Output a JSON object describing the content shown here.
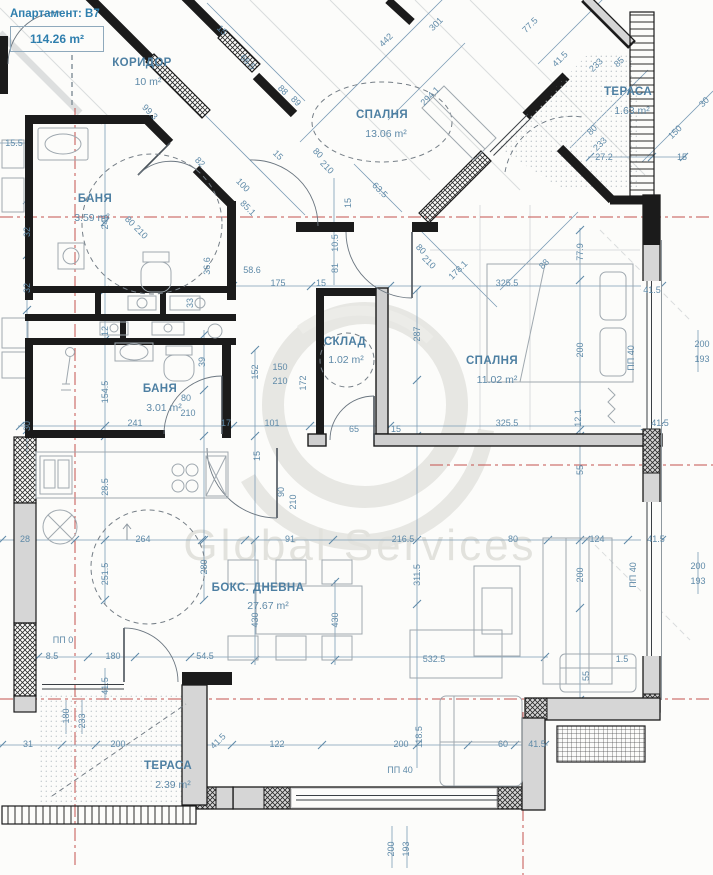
{
  "header": {
    "apartment_label": "Апартамент: B7",
    "total_area": "114.26 m²"
  },
  "watermark": "Global Services",
  "colors": {
    "dimension_blue": "#5f8aa8",
    "room_label_blue": "#4d7fa2",
    "axis_red": "#c4524e",
    "wall_black": "#1b1b1b",
    "wall_gray": "#d6d6d6"
  },
  "rooms": [
    {
      "name": "КОРИДОР",
      "area": "10 m²",
      "x": 142,
      "y": 63,
      "ax": 148,
      "ay": 82
    },
    {
      "name": "СПАЛНЯ",
      "area": "13.06 m²",
      "x": 382,
      "y": 115,
      "ax": 386,
      "ay": 134
    },
    {
      "name": "ТЕРАСА",
      "area": "1.63 m²",
      "x": 628,
      "y": 92,
      "ax": 632,
      "ay": 111
    },
    {
      "name": "БАНЯ",
      "area": "3.59 m²",
      "x": 95,
      "y": 199,
      "ax": 92,
      "ay": 218
    },
    {
      "name": "СКЛАД",
      "area": "1.02 m²",
      "x": 345,
      "y": 342,
      "ax": 346,
      "ay": 360
    },
    {
      "name": "СПАЛНЯ",
      "area": "11.02 m²",
      "x": 492,
      "y": 361,
      "ax": 497,
      "ay": 380
    },
    {
      "name": "БАНЯ",
      "area": "3.01 m²",
      "x": 160,
      "y": 389,
      "ax": 164,
      "ay": 408
    },
    {
      "name": "БОКС. ДНЕВНА",
      "area": "27.67 m²",
      "x": 258,
      "y": 588,
      "ax": 268,
      "ay": 606
    },
    {
      "name": "ТЕРАСА",
      "area": "2.39 m²",
      "x": 168,
      "y": 766,
      "ax": 173,
      "ay": 785
    }
  ],
  "dim_labels": [
    {
      "t": "99.3",
      "x": 150,
      "y": 112,
      "r": 45
    },
    {
      "t": "82",
      "x": 200,
      "y": 162,
      "r": 45
    },
    {
      "t": "100",
      "x": 243,
      "y": 185,
      "r": 45
    },
    {
      "t": "85.1",
      "x": 248,
      "y": 208,
      "r": 45
    },
    {
      "t": "80",
      "x": 130,
      "y": 221,
      "r": 45
    },
    {
      "t": "210",
      "x": 141,
      "y": 232,
      "r": 45
    },
    {
      "t": "15",
      "x": 278,
      "y": 155,
      "r": 45
    },
    {
      "t": "88",
      "x": 283,
      "y": 90,
      "r": 45
    },
    {
      "t": "89",
      "x": 296,
      "y": 101,
      "r": 45
    },
    {
      "t": "66.5",
      "x": 248,
      "y": 62,
      "r": 45
    },
    {
      "t": "15",
      "x": 222,
      "y": 30,
      "r": 45
    },
    {
      "t": "80",
      "x": 318,
      "y": 153,
      "r": 45
    },
    {
      "t": "210",
      "x": 327,
      "y": 167,
      "r": 45
    },
    {
      "t": "63.5",
      "x": 380,
      "y": 190,
      "r": 45
    },
    {
      "t": "15",
      "x": 348,
      "y": 203,
      "r": -90
    },
    {
      "t": "10.5",
      "x": 335,
      "y": 243,
      "r": -90
    },
    {
      "t": "81",
      "x": 335,
      "y": 268,
      "r": -90
    },
    {
      "t": "442",
      "x": 386,
      "y": 40,
      "r": -45
    },
    {
      "t": "301",
      "x": 436,
      "y": 24,
      "r": -45
    },
    {
      "t": "294.1",
      "x": 430,
      "y": 96,
      "r": -45
    },
    {
      "t": "77.5",
      "x": 530,
      "y": 25,
      "r": -45
    },
    {
      "t": "41.5",
      "x": 560,
      "y": 59,
      "r": -45
    },
    {
      "t": "233",
      "x": 596,
      "y": 65,
      "r": -45
    },
    {
      "t": "85",
      "x": 619,
      "y": 62,
      "r": -45
    },
    {
      "t": "80",
      "x": 592,
      "y": 130,
      "r": -45
    },
    {
      "t": "233",
      "x": 600,
      "y": 144,
      "r": -45
    },
    {
      "t": "150",
      "x": 675,
      "y": 132,
      "r": -45
    },
    {
      "t": "30",
      "x": 704,
      "y": 102,
      "r": -45
    },
    {
      "t": "27.2",
      "x": 604,
      "y": 157,
      "r": 0
    },
    {
      "t": "15",
      "x": 682,
      "y": 157,
      "r": 0
    },
    {
      "t": "88",
      "x": 544,
      "y": 264,
      "r": -45
    },
    {
      "t": "178.1",
      "x": 458,
      "y": 270,
      "r": -45
    },
    {
      "t": "80",
      "x": 421,
      "y": 249,
      "r": 45
    },
    {
      "t": "210",
      "x": 429,
      "y": 262,
      "r": 45
    },
    {
      "t": "58.6",
      "x": 252,
      "y": 270,
      "r": 0
    },
    {
      "t": "175",
      "x": 278,
      "y": 283,
      "r": 0
    },
    {
      "t": "15",
      "x": 321,
      "y": 283,
      "r": 0
    },
    {
      "t": "325.5",
      "x": 507,
      "y": 283,
      "r": 0
    },
    {
      "t": "41.5",
      "x": 652,
      "y": 290,
      "r": 0
    },
    {
      "t": "325.5",
      "x": 507,
      "y": 423,
      "r": 0
    },
    {
      "t": "41.5",
      "x": 660,
      "y": 423,
      "r": 0
    },
    {
      "t": "241",
      "x": 135,
      "y": 423,
      "r": 0
    },
    {
      "t": "17",
      "x": 226,
      "y": 423,
      "r": 0
    },
    {
      "t": "101",
      "x": 272,
      "y": 423,
      "r": 0
    },
    {
      "t": "65",
      "x": 354,
      "y": 429,
      "r": 0
    },
    {
      "t": "15",
      "x": 396,
      "y": 429,
      "r": 0
    },
    {
      "t": "150",
      "x": 280,
      "y": 367,
      "r": 0
    },
    {
      "t": "210",
      "x": 280,
      "y": 381,
      "r": 0
    },
    {
      "t": "245",
      "x": 105,
      "y": 222,
      "r": -90
    },
    {
      "t": "12",
      "x": 105,
      "y": 331,
      "r": -90
    },
    {
      "t": "32",
      "x": 27,
      "y": 232,
      "r": -90
    },
    {
      "t": "32",
      "x": 27,
      "y": 288,
      "r": -90
    },
    {
      "t": "33",
      "x": 190,
      "y": 303,
      "r": -90
    },
    {
      "t": "36.6",
      "x": 207,
      "y": 266,
      "r": -90
    },
    {
      "t": "154.5",
      "x": 105,
      "y": 392,
      "r": -90
    },
    {
      "t": "39",
      "x": 202,
      "y": 362,
      "r": -90
    },
    {
      "t": "30",
      "x": 27,
      "y": 426,
      "r": -90
    },
    {
      "t": "28.5",
      "x": 105,
      "y": 487,
      "r": -90
    },
    {
      "t": "251.5",
      "x": 105,
      "y": 574,
      "r": -90
    },
    {
      "t": "280",
      "x": 204,
      "y": 567,
      "r": -90
    },
    {
      "t": "152",
      "x": 255,
      "y": 372,
      "r": -90
    },
    {
      "t": "172",
      "x": 303,
      "y": 383,
      "r": -90
    },
    {
      "t": "287",
      "x": 417,
      "y": 334,
      "r": -90
    },
    {
      "t": "90",
      "x": 281,
      "y": 492,
      "r": -90
    },
    {
      "t": "210",
      "x": 293,
      "y": 502,
      "r": -90
    },
    {
      "t": "15",
      "x": 257,
      "y": 456,
      "r": -90
    },
    {
      "t": "311.5",
      "x": 417,
      "y": 575,
      "r": -90
    },
    {
      "t": "430",
      "x": 255,
      "y": 620,
      "r": -90
    },
    {
      "t": "430",
      "x": 335,
      "y": 620,
      "r": -90
    },
    {
      "t": "118.5",
      "x": 419,
      "y": 737,
      "r": -90
    },
    {
      "t": "77.9",
      "x": 580,
      "y": 252,
      "r": -90
    },
    {
      "t": "200",
      "x": 580,
      "y": 350,
      "r": -90
    },
    {
      "t": "12.1",
      "x": 578,
      "y": 418,
      "r": -90
    },
    {
      "t": "55",
      "x": 580,
      "y": 470,
      "r": -90
    },
    {
      "t": "200",
      "x": 580,
      "y": 575,
      "r": -90
    },
    {
      "t": "55",
      "x": 586,
      "y": 676,
      "r": -90
    },
    {
      "t": "41.5",
      "x": 105,
      "y": 686,
      "r": -90
    },
    {
      "t": "180",
      "x": 66,
      "y": 716,
      "r": -90
    },
    {
      "t": "233",
      "x": 82,
      "y": 721,
      "r": -90
    },
    {
      "t": "200",
      "x": 391,
      "y": 849,
      "r": -90
    },
    {
      "t": "193",
      "x": 406,
      "y": 849,
      "r": -90
    },
    {
      "t": "ПП 40",
      "x": 631,
      "y": 358,
      "r": -90
    },
    {
      "t": "ПП 40",
      "x": 633,
      "y": 575,
      "r": -90
    },
    {
      "t": "80",
      "x": 186,
      "y": 398,
      "r": 0
    },
    {
      "t": "210",
      "x": 188,
      "y": 413,
      "r": 0
    },
    {
      "t": "15.5",
      "x": 14,
      "y": 143,
      "r": 0
    },
    {
      "t": "28",
      "x": 25,
      "y": 539,
      "r": 0
    },
    {
      "t": "264",
      "x": 143,
      "y": 539,
      "r": 0
    },
    {
      "t": "91",
      "x": 290,
      "y": 539,
      "r": 0
    },
    {
      "t": "216.5",
      "x": 403,
      "y": 539,
      "r": 0
    },
    {
      "t": "80",
      "x": 513,
      "y": 539,
      "r": 0
    },
    {
      "t": "124",
      "x": 597,
      "y": 539,
      "r": 0
    },
    {
      "t": "41.5",
      "x": 656,
      "y": 539,
      "r": 0
    },
    {
      "t": "1.5",
      "x": 622,
      "y": 659,
      "r": 0
    },
    {
      "t": "532.5",
      "x": 434,
      "y": 659,
      "r": 0
    },
    {
      "t": "8.5",
      "x": 52,
      "y": 656,
      "r": 0
    },
    {
      "t": "180",
      "x": 113,
      "y": 656,
      "r": 0
    },
    {
      "t": "54.5",
      "x": 205,
      "y": 656,
      "r": 0
    },
    {
      "t": "31",
      "x": 28,
      "y": 744,
      "r": 0
    },
    {
      "t": "200",
      "x": 118,
      "y": 744,
      "r": 0
    },
    {
      "t": "41.5",
      "x": 218,
      "y": 741,
      "r": -45
    },
    {
      "t": "122",
      "x": 277,
      "y": 744,
      "r": 0
    },
    {
      "t": "200",
      "x": 401,
      "y": 744,
      "r": 0
    },
    {
      "t": "60",
      "x": 503,
      "y": 744,
      "r": 0
    },
    {
      "t": "41.5",
      "x": 537,
      "y": 744,
      "r": 0
    },
    {
      "t": "ПП 40",
      "x": 400,
      "y": 770,
      "r": 0
    },
    {
      "t": "ПП 0",
      "x": 63,
      "y": 640,
      "r": 0
    },
    {
      "t": "200",
      "x": 702,
      "y": 344,
      "r": 0
    },
    {
      "t": "193",
      "x": 702,
      "y": 359,
      "r": 0
    },
    {
      "t": "200",
      "x": 698,
      "y": 566,
      "r": 0
    },
    {
      "t": "193",
      "x": 698,
      "y": 581,
      "r": 0
    }
  ]
}
